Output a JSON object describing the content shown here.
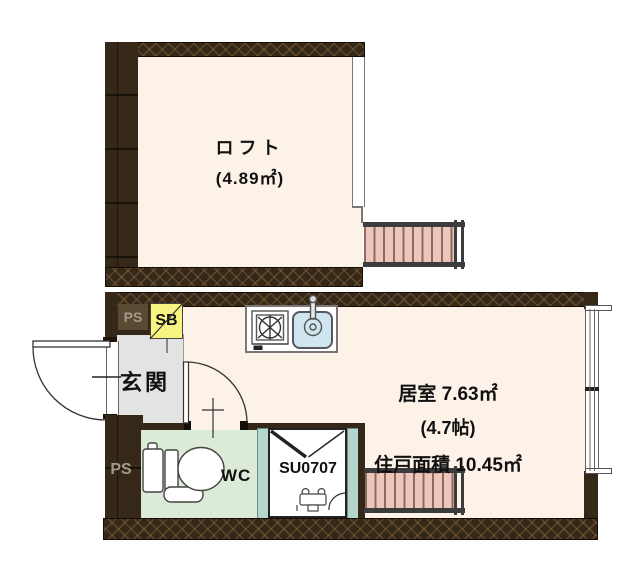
{
  "rooms": {
    "loft": {
      "label": "ロフト",
      "area": "(4.89㎡)"
    },
    "living": {
      "label": "居室 7.63㎡",
      "tatami": "(4.7帖)",
      "unit_area": "住戸面積 10.45㎡"
    },
    "entrance": {
      "label": "玄関"
    },
    "toilet": {
      "label": "WC"
    },
    "shower_unit": {
      "label": "SU0707"
    }
  },
  "wall_labels": {
    "storage_box": "SB",
    "pipe_space_upper": "PS",
    "pipe_space_lower": "PS"
  },
  "colors": {
    "wall": "#362818",
    "floor": "#fcf2e7",
    "entrance_floor": "#e3e3e3",
    "wc_floor": "#dcead8",
    "storage_box": "#f7f481",
    "sink": "#cfe6ee",
    "ladder": "#edc6bb",
    "shower_panel": "#b5d6cd"
  }
}
